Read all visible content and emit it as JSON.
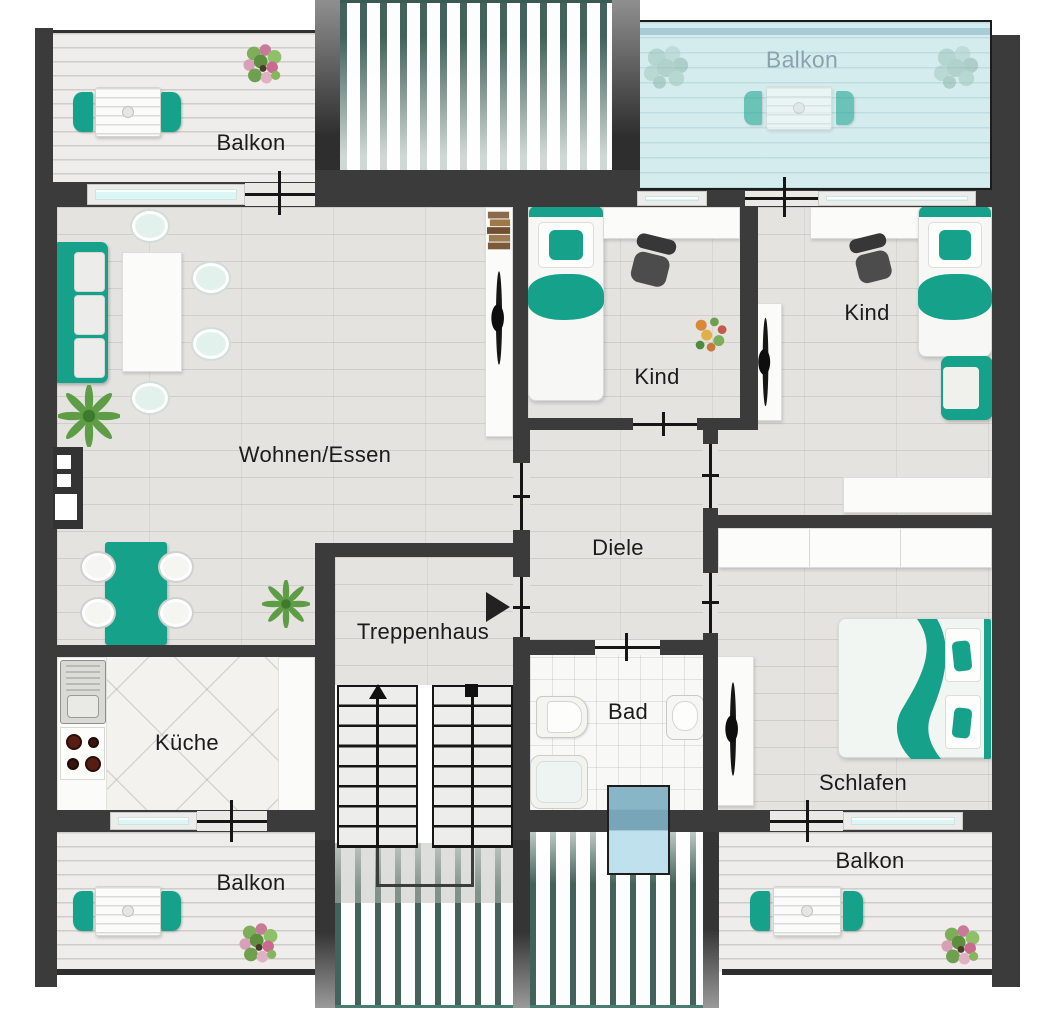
{
  "rooms": {
    "balkon_top_left": "Balkon",
    "balkon_top_right": "Balkon",
    "wohnen_essen": "Wohnen/Essen",
    "kind_mitte": "Kind",
    "kind_rechts": "Kind",
    "diele": "Diele",
    "treppenhaus": "Treppenhaus",
    "kueche": "Küche",
    "bad": "Bad",
    "schlafen": "Schlafen",
    "balkon_unten_links": "Balkon",
    "balkon_unten_rechts": "Balkon"
  },
  "colors": {
    "wall": "#3b3b3b",
    "accent-teal": "#16a28a",
    "chair-teal": "#e3f1ed",
    "floor": "#e4e3e0",
    "balcony-floor": "#eeedeb",
    "blue-balcony": "#d5ecef",
    "glass": "#dcf6f6",
    "hatch-stripe": "#43635a",
    "skylight": "#a9d5e5",
    "label": "#1b1b1b",
    "label-faded": "#8ba2ae"
  }
}
